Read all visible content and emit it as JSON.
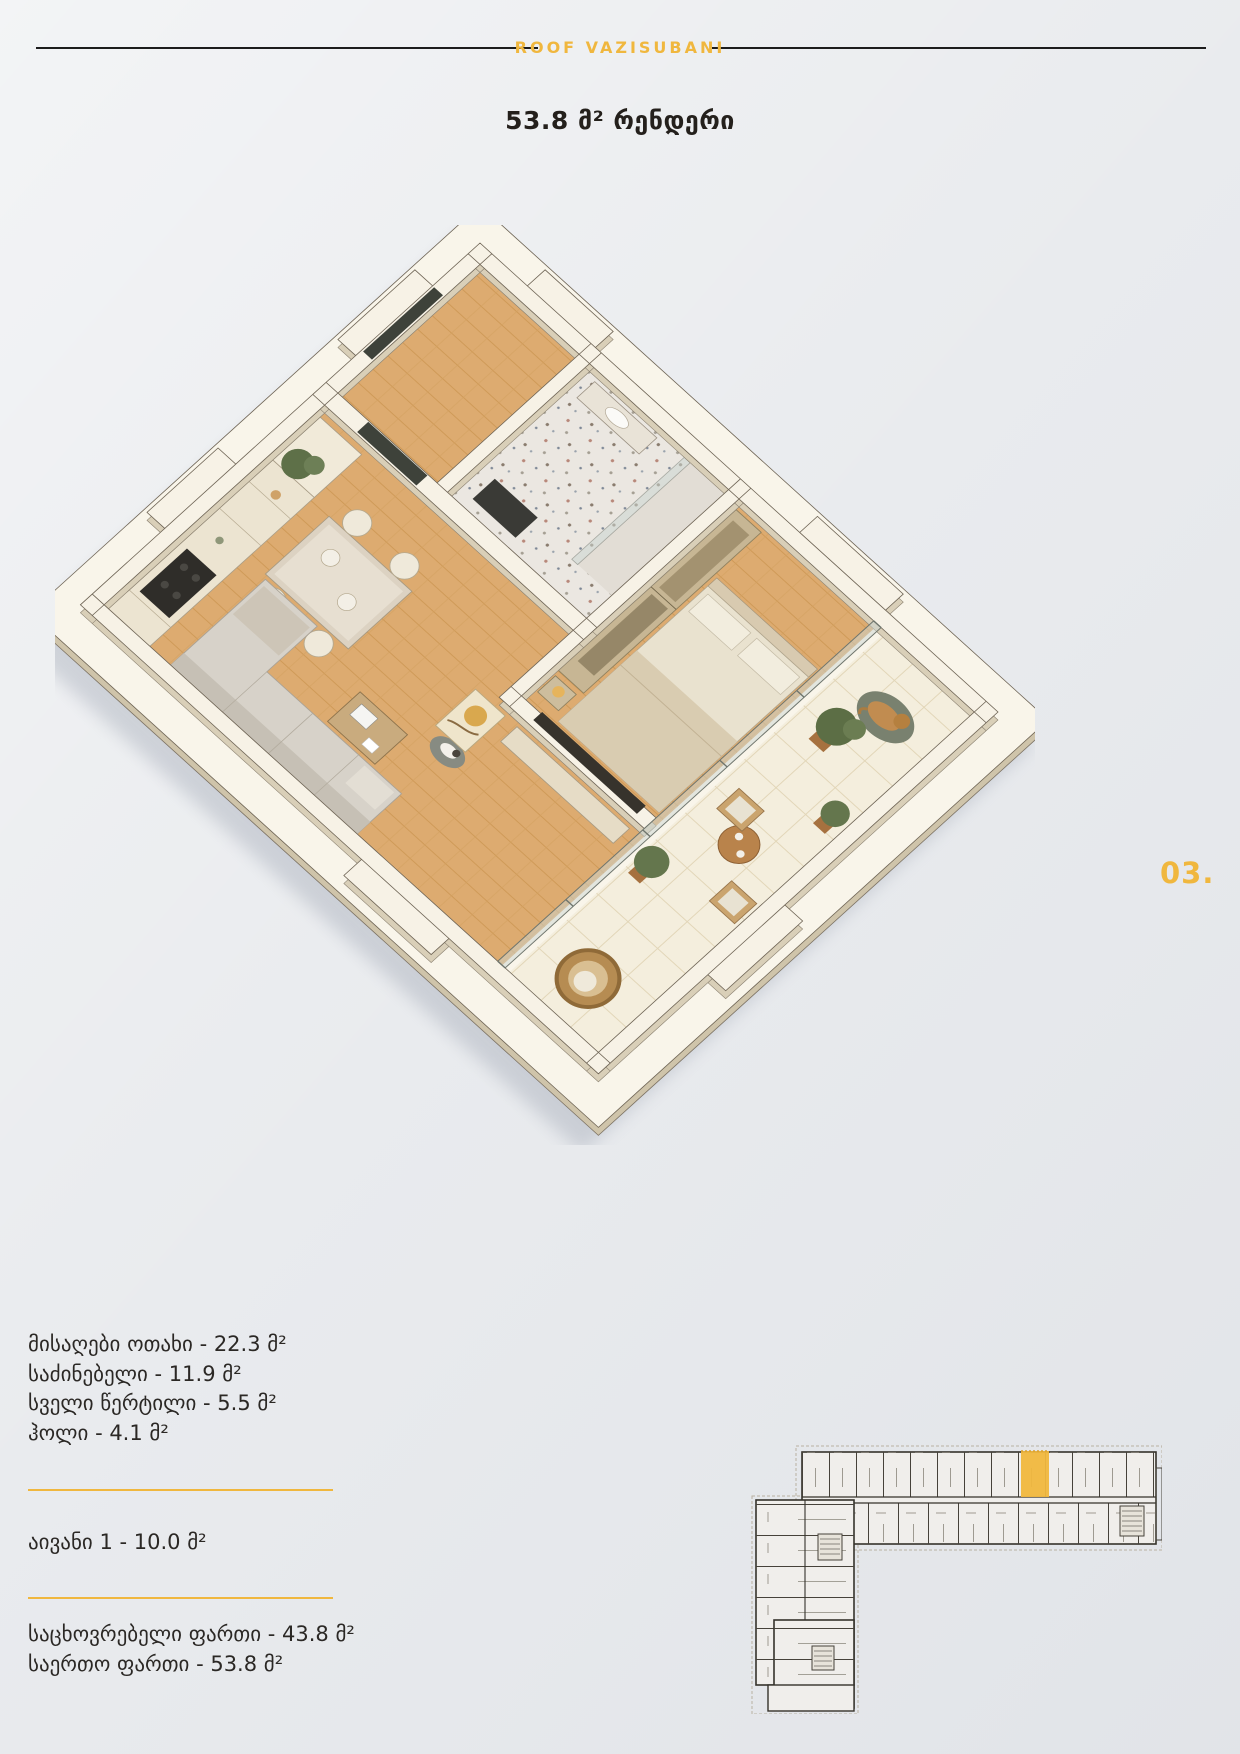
{
  "header": {
    "brand": "ROOF VAZISUBANI"
  },
  "title": "53.8 მ² რენდერი",
  "page_number": "03.",
  "areas": {
    "rooms": [
      "მისაღები ოთახი - 22.3 მ²",
      "საძინებელი - 11.9 მ²",
      "სველი წერტილი - 5.5 მ²",
      "ჰოლი - 4.1 მ²"
    ],
    "balcony": "აივანი 1 - 10.0 მ²",
    "totals": [
      "საცხოვრებელი ფართი - 43.8 მ²",
      "საერთო ფართი - 53.8 მ²"
    ]
  },
  "colors": {
    "css": {
      "accent": "#F0B73E",
      "ink": "#24201c",
      "bg": "#e9ebee",
      "rule": "#1c1c1c"
    },
    "minimap_highlight": "#F6BE41",
    "render": {
      "wood_floor": "#DDAB70",
      "walls": "#F7F2E6",
      "balcony_tile": "#F4EEDD",
      "slab": "#F9F5EA",
      "tv": "#37332C",
      "entry_door": "#3E423A"
    }
  }
}
